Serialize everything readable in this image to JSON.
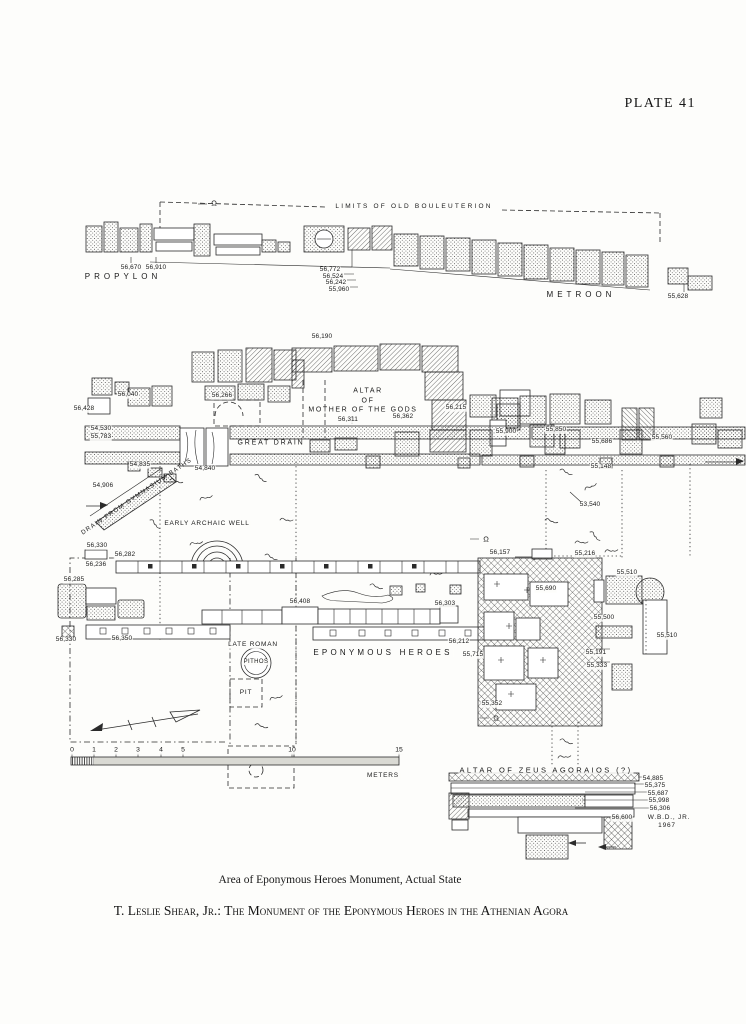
{
  "page": {
    "plate_label": "PLATE 41",
    "caption": "Area of Eponymous Heroes Monument, Actual State",
    "footer": "T. Leslie Shear, Jr.: The Monument of the Eponymous Heroes in the Athenian Agora"
  },
  "plan": {
    "labels": [
      {
        "t": "LIMITS OF OLD BOULEUTERION",
        "x": 414,
        "y": 207,
        "c": "lim",
        "n": "label-limits-of-old-bouleuterion"
      },
      {
        "t": "Ω",
        "x": 214,
        "y": 203,
        "c": "sec",
        "n": "section-marker-omega"
      },
      {
        "t": "PROPYLON",
        "x": 123,
        "y": 277,
        "c": "p",
        "n": "label-propylon"
      },
      {
        "t": "METROON",
        "x": 581,
        "y": 295,
        "c": "p",
        "n": "label-metroon"
      },
      {
        "t": "56,670",
        "x": 131,
        "y": 268,
        "c": "e",
        "n": "elevation-label"
      },
      {
        "t": "56,910",
        "x": 156,
        "y": 268,
        "c": "e",
        "n": "elevation-label"
      },
      {
        "t": "56,772",
        "x": 330,
        "y": 270,
        "c": "e",
        "n": "elevation-label"
      },
      {
        "t": "56,524",
        "x": 333,
        "y": 277,
        "c": "e",
        "n": "elevation-label"
      },
      {
        "t": "56,242",
        "x": 336,
        "y": 283,
        "c": "e",
        "n": "elevation-label"
      },
      {
        "t": "55,960",
        "x": 339,
        "y": 290,
        "c": "e",
        "n": "elevation-label"
      },
      {
        "t": "55,628",
        "x": 678,
        "y": 297,
        "c": "e",
        "n": "elevation-label"
      },
      {
        "t": "56,190",
        "x": 322,
        "y": 337,
        "c": "e",
        "n": "elevation-label"
      },
      {
        "t": "56,040",
        "x": 128,
        "y": 395,
        "c": "e",
        "n": "elevation-label"
      },
      {
        "t": "56,266",
        "x": 222,
        "y": 396,
        "c": "e",
        "n": "elevation-label"
      },
      {
        "t": "56,428",
        "x": 84,
        "y": 409,
        "c": "e",
        "n": "elevation-label"
      },
      {
        "t": "54,530",
        "x": 101,
        "y": 429,
        "c": "e",
        "n": "elevation-label"
      },
      {
        "t": "55,783",
        "x": 101,
        "y": 437,
        "c": "e",
        "n": "elevation-label"
      },
      {
        "t": "GREAT DRAIN",
        "x": 271,
        "y": 443,
        "c": "gd",
        "n": "label-great-drain"
      },
      {
        "t": "54,835",
        "x": 140,
        "y": 465,
        "c": "e",
        "n": "elevation-label"
      },
      {
        "t": "54,840",
        "x": 205,
        "y": 469,
        "c": "e",
        "n": "elevation-label"
      },
      {
        "t": "54,906",
        "x": 103,
        "y": 486,
        "c": "e",
        "n": "elevation-label"
      },
      {
        "t": "DRAIN FROM GYMNASIUM BATHS",
        "x": 137,
        "y": 497,
        "c": "rot",
        "r": -34,
        "n": "label-drain-from-gymnasium-baths"
      },
      {
        "t": "EARLY ARCHAIC WELL",
        "x": 207,
        "y": 524,
        "c": "s",
        "n": "label-early-archaic-well"
      },
      {
        "t": "ALTAR",
        "x": 368,
        "y": 391,
        "c": "s2",
        "n": "label-altar-of-mother-line1"
      },
      {
        "t": "OF",
        "x": 368,
        "y": 401,
        "c": "s2",
        "n": "label-altar-of-mother-line2"
      },
      {
        "t": "MOTHER OF THE GODS",
        "x": 363,
        "y": 410,
        "c": "s2",
        "n": "label-altar-of-mother-line3"
      },
      {
        "t": "56,311",
        "x": 348,
        "y": 420,
        "c": "e",
        "n": "elevation-label"
      },
      {
        "t": "56,362",
        "x": 403,
        "y": 417,
        "c": "e",
        "n": "elevation-label"
      },
      {
        "t": "56,215",
        "x": 456,
        "y": 408,
        "c": "e",
        "n": "elevation-label"
      },
      {
        "t": "55,900",
        "x": 506,
        "y": 432,
        "c": "e",
        "n": "elevation-label"
      },
      {
        "t": "55,850",
        "x": 556,
        "y": 430,
        "c": "e",
        "n": "elevation-label"
      },
      {
        "t": "55,686",
        "x": 602,
        "y": 442,
        "c": "e",
        "n": "elevation-label"
      },
      {
        "t": "55,560",
        "x": 662,
        "y": 438,
        "c": "e",
        "n": "elevation-label"
      },
      {
        "t": "55,148",
        "x": 601,
        "y": 467,
        "c": "e",
        "n": "elevation-label"
      },
      {
        "t": "53,540",
        "x": 590,
        "y": 505,
        "c": "e",
        "n": "elevation-label"
      },
      {
        "t": "56,330",
        "x": 97,
        "y": 546,
        "c": "e",
        "n": "elevation-label"
      },
      {
        "t": "56,282",
        "x": 125,
        "y": 555,
        "c": "e",
        "n": "elevation-label"
      },
      {
        "t": "56,236",
        "x": 96,
        "y": 565,
        "c": "e",
        "n": "elevation-label"
      },
      {
        "t": "56,285",
        "x": 74,
        "y": 580,
        "c": "e",
        "n": "elevation-label"
      },
      {
        "t": "Ω",
        "x": 486,
        "y": 539,
        "c": "sec",
        "n": "section-marker-omega"
      },
      {
        "t": "56,157",
        "x": 500,
        "y": 553,
        "c": "e",
        "n": "elevation-label"
      },
      {
        "t": "55,216",
        "x": 585,
        "y": 554,
        "c": "e",
        "n": "elevation-label"
      },
      {
        "t": "55,510",
        "x": 627,
        "y": 573,
        "c": "e",
        "n": "elevation-label"
      },
      {
        "t": "55,690",
        "x": 546,
        "y": 589,
        "c": "e",
        "n": "elevation-label"
      },
      {
        "t": "56,408",
        "x": 300,
        "y": 602,
        "c": "e",
        "n": "elevation-label"
      },
      {
        "t": "56,303",
        "x": 445,
        "y": 604,
        "c": "e",
        "n": "elevation-label"
      },
      {
        "t": "55,500",
        "x": 604,
        "y": 618,
        "c": "e",
        "n": "elevation-label"
      },
      {
        "t": "55,510",
        "x": 667,
        "y": 636,
        "c": "e",
        "n": "elevation-label"
      },
      {
        "t": "56,330",
        "x": 66,
        "y": 640,
        "c": "e",
        "n": "elevation-label"
      },
      {
        "t": "56,350",
        "x": 122,
        "y": 639,
        "c": "e",
        "n": "elevation-label"
      },
      {
        "t": "56,212",
        "x": 459,
        "y": 642,
        "c": "e",
        "n": "elevation-label"
      },
      {
        "t": "LATE ROMAN",
        "x": 253,
        "y": 645,
        "c": "s",
        "n": "label-late-roman"
      },
      {
        "t": "EPONYMOUS  HEROES",
        "x": 383,
        "y": 653,
        "c": "px",
        "n": "label-eponymous-heroes"
      },
      {
        "t": "55,715",
        "x": 473,
        "y": 655,
        "c": "e",
        "n": "elevation-label"
      },
      {
        "t": "55,191",
        "x": 596,
        "y": 653,
        "c": "e",
        "n": "elevation-label"
      },
      {
        "t": "PITHOS",
        "x": 256,
        "y": 662,
        "c": "s3",
        "n": "label-pithos"
      },
      {
        "t": "55,333",
        "x": 597,
        "y": 666,
        "c": "e",
        "n": "elevation-label"
      },
      {
        "t": "PIT",
        "x": 246,
        "y": 693,
        "c": "s",
        "n": "label-pit"
      },
      {
        "t": "55,352",
        "x": 492,
        "y": 704,
        "c": "e",
        "n": "elevation-label"
      },
      {
        "t": "Ω",
        "x": 496,
        "y": 718,
        "c": "sec",
        "n": "section-marker-omega"
      },
      {
        "t": "0",
        "x": 72,
        "y": 751,
        "c": "num",
        "n": "scale-tick-label"
      },
      {
        "t": "1",
        "x": 94,
        "y": 751,
        "c": "num",
        "n": "scale-tick-label"
      },
      {
        "t": "2",
        "x": 116,
        "y": 751,
        "c": "num",
        "n": "scale-tick-label"
      },
      {
        "t": "3",
        "x": 138,
        "y": 751,
        "c": "num",
        "n": "scale-tick-label"
      },
      {
        "t": "4",
        "x": 161,
        "y": 751,
        "c": "num",
        "n": "scale-tick-label"
      },
      {
        "t": "5",
        "x": 183,
        "y": 751,
        "c": "num",
        "n": "scale-tick-label"
      },
      {
        "t": "10",
        "x": 292,
        "y": 751,
        "c": "num",
        "n": "scale-tick-label"
      },
      {
        "t": "15",
        "x": 399,
        "y": 751,
        "c": "num",
        "n": "scale-tick-label"
      },
      {
        "t": "METERS",
        "x": 383,
        "y": 776,
        "c": "s",
        "n": "scale-unit-label"
      },
      {
        "t": "ALTAR OF ZEUS AGORAIOS (?)",
        "x": 546,
        "y": 770,
        "c": "pz",
        "n": "label-altar-of-zeus-agoraios"
      },
      {
        "t": "54,885",
        "x": 653,
        "y": 779,
        "c": "e",
        "n": "elevation-label"
      },
      {
        "t": "55,375",
        "x": 655,
        "y": 786,
        "c": "e",
        "n": "elevation-label"
      },
      {
        "t": "55,687",
        "x": 658,
        "y": 794,
        "c": "e",
        "n": "elevation-label"
      },
      {
        "t": "55,998",
        "x": 659,
        "y": 801,
        "c": "e",
        "n": "elevation-label"
      },
      {
        "t": "56,306",
        "x": 660,
        "y": 809,
        "c": "e",
        "n": "elevation-label"
      },
      {
        "t": "56,600",
        "x": 622,
        "y": 818,
        "c": "e",
        "n": "elevation-label"
      },
      {
        "t": "W.B.D., JR.",
        "x": 669,
        "y": 818,
        "c": "s",
        "n": "credit-draftsman"
      },
      {
        "t": "1967",
        "x": 667,
        "y": 826,
        "c": "s",
        "n": "credit-year"
      }
    ]
  }
}
